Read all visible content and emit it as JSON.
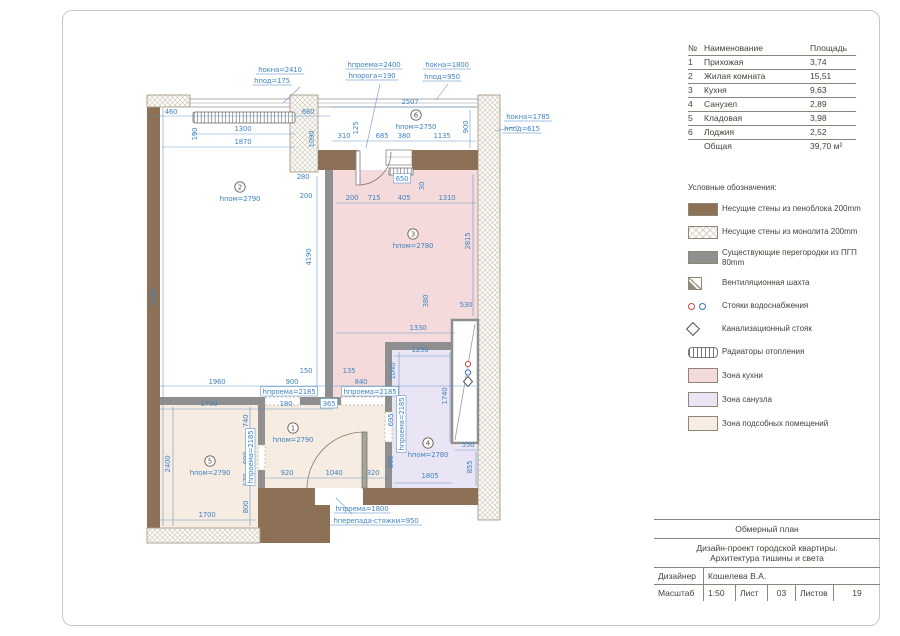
{
  "colors": {
    "wall_brown": "#8c7156",
    "partition_gray": "#8f8f8f",
    "zone_kitchen": "#f4dada",
    "zone_bath": "#e9e5f4",
    "zone_utility": "#f7ece2",
    "dim_blue": "#4385c2"
  },
  "table": {
    "headers": [
      "№",
      "Наименование",
      "Площадь"
    ],
    "rows": [
      [
        "1",
        "Прихожая",
        "3,74"
      ],
      [
        "2",
        "Жилая комната",
        "15,51"
      ],
      [
        "3",
        "Кухня",
        "9,63"
      ],
      [
        "4",
        "Санузел",
        "2,89"
      ],
      [
        "5",
        "Кладовая",
        "3,98"
      ],
      [
        "6",
        "Лоджия",
        "2,52"
      ]
    ],
    "total_label": "Общая",
    "total_value": "39,70 м²"
  },
  "legend": {
    "title": "Условные обозначения:",
    "items": [
      {
        "type": "color",
        "color": "#8c7156",
        "icon": "wall-foamblock-swatch",
        "label": "Несущие стены из пеноблока 200mm"
      },
      {
        "type": "hatch",
        "icon": "wall-monolith-swatch",
        "label": "Несущие стены из монолита 200mm"
      },
      {
        "type": "color",
        "color": "#8f8f8f",
        "icon": "partition-swatch",
        "label": "Существующие перегородки из ПГП 80mm"
      },
      {
        "type": "vent",
        "icon": "vent-shaft-icon",
        "label": "Вентиляционная шахта"
      },
      {
        "type": "risers",
        "dot_colors": [
          "#c34a3f",
          "#3f6fbc"
        ],
        "icon": "water-risers-icon",
        "label": "Стояки водоснабжения"
      },
      {
        "type": "diamond",
        "icon": "sewer-riser-icon",
        "label": "Канализационный стояк"
      },
      {
        "type": "radiator",
        "icon": "radiator-icon",
        "label": "Радиаторы отопления"
      },
      {
        "type": "zone",
        "color": "#f4dada",
        "icon": "kitchen-zone-swatch",
        "label": "Зона кухни"
      },
      {
        "type": "zone",
        "color": "#e9e5f4",
        "icon": "bath-zone-swatch",
        "label": "Зона санузла"
      },
      {
        "type": "zone",
        "color": "#f7ece2",
        "icon": "utility-zone-swatch",
        "label": "Зона подсобных помещений"
      }
    ]
  },
  "titleblock": {
    "plan_title": "Обмерный план",
    "project_line1": "Дизайн-проект городской квартиры.",
    "project_line2": "Архитектура тишины и света",
    "designer_label": "Дизайнер",
    "designer": "Кошелева В.А.",
    "scale_label": "Масштаб",
    "scale": "1:50",
    "sheet_label": "Лист",
    "sheet": "03",
    "sheets_label": "Листов",
    "sheets": "19"
  },
  "plan": {
    "rooms": [
      {
        "n": "2",
        "x": 240,
        "y": 187,
        "h": "hпом=2790"
      },
      {
        "n": "6",
        "x": 416,
        "y": 115,
        "h": "hпом=2750"
      },
      {
        "n": "3",
        "x": 413,
        "y": 234,
        "h": "hпом=2780"
      },
      {
        "n": "4",
        "x": 428,
        "y": 443,
        "h": "hпом=2780"
      },
      {
        "n": "1",
        "x": 293,
        "y": 428,
        "h": "hпом=2790"
      },
      {
        "n": "5",
        "x": 210,
        "y": 461,
        "h": "hпом=2790"
      }
    ],
    "dims": [
      {
        "t": "hокна=2410",
        "x": 280,
        "y": 72,
        "u": 1
      },
      {
        "t": "hпод=175",
        "x": 272,
        "y": 83,
        "u": 1
      },
      {
        "t": "hпроема=2400",
        "x": 374,
        "y": 67,
        "u": 1
      },
      {
        "t": "hпорога=190",
        "x": 372,
        "y": 78,
        "u": 1
      },
      {
        "t": "hокна=1800",
        "x": 447,
        "y": 67,
        "u": 1
      },
      {
        "t": "hпод=950",
        "x": 442,
        "y": 79,
        "u": 1
      },
      {
        "t": "hокна=1785",
        "x": 528,
        "y": 119,
        "u": 1
      },
      {
        "t": "hпод=615",
        "x": 522,
        "y": 131,
        "u": 1
      },
      {
        "t": "hпроема=1800",
        "x": 362,
        "y": 511,
        "u": 1
      },
      {
        "t": "hперепада-стяжки=950",
        "x": 376,
        "y": 523,
        "u": 1
      },
      {
        "t": "460",
        "x": 171,
        "y": 114
      },
      {
        "t": "1300",
        "x": 243,
        "y": 131
      },
      {
        "t": "1870",
        "x": 243,
        "y": 144
      },
      {
        "t": "190",
        "x": 197,
        "y": 134,
        "r": 1
      },
      {
        "t": "680",
        "x": 308,
        "y": 114
      },
      {
        "t": "1090",
        "x": 314,
        "y": 139,
        "r": 1
      },
      {
        "t": "2507",
        "x": 410,
        "y": 104
      },
      {
        "t": "900",
        "x": 468,
        "y": 127,
        "r": 1
      },
      {
        "t": "310",
        "x": 344,
        "y": 138
      },
      {
        "t": "125",
        "x": 358,
        "y": 128,
        "r": 1
      },
      {
        "t": "685",
        "x": 382,
        "y": 138
      },
      {
        "t": "380",
        "x": 404,
        "y": 138
      },
      {
        "t": "1135",
        "x": 442,
        "y": 138
      },
      {
        "t": "650",
        "x": 402,
        "y": 181,
        "b": 1
      },
      {
        "t": "30",
        "x": 424,
        "y": 186,
        "r": 1
      },
      {
        "t": "200",
        "x": 352,
        "y": 200
      },
      {
        "t": "715",
        "x": 374,
        "y": 200
      },
      {
        "t": "405",
        "x": 404,
        "y": 200
      },
      {
        "t": "1310",
        "x": 447,
        "y": 200
      },
      {
        "t": "280",
        "x": 303,
        "y": 179
      },
      {
        "t": "200",
        "x": 306,
        "y": 198
      },
      {
        "t": "2815",
        "x": 470,
        "y": 241,
        "r": 1
      },
      {
        "t": "4190",
        "x": 311,
        "y": 257,
        "r": 1
      },
      {
        "t": "5280",
        "x": 156,
        "y": 297,
        "r": 1
      },
      {
        "t": "380",
        "x": 428,
        "y": 301,
        "r": 1
      },
      {
        "t": "530",
        "x": 466,
        "y": 307
      },
      {
        "t": "1330",
        "x": 418,
        "y": 330
      },
      {
        "t": "1250",
        "x": 420,
        "y": 352
      },
      {
        "t": "1040",
        "x": 395,
        "y": 371,
        "r": 1
      },
      {
        "t": "1740",
        "x": 447,
        "y": 396,
        "r": 1
      },
      {
        "t": "150",
        "x": 306,
        "y": 373
      },
      {
        "t": "135",
        "x": 349,
        "y": 373
      },
      {
        "t": "1960",
        "x": 217,
        "y": 384
      },
      {
        "t": "900",
        "x": 292,
        "y": 384
      },
      {
        "t": "840",
        "x": 361,
        "y": 384
      },
      {
        "t": "hпроема=2185",
        "x": 289,
        "y": 394,
        "b": 1
      },
      {
        "t": "hпроема=2185",
        "x": 370,
        "y": 394,
        "b": 1
      },
      {
        "t": "1700",
        "x": 209,
        "y": 406
      },
      {
        "t": "180",
        "x": 286,
        "y": 406
      },
      {
        "t": "365",
        "x": 329,
        "y": 406,
        "b": 1
      },
      {
        "t": "740",
        "x": 248,
        "y": 421,
        "r": 1
      },
      {
        "t": "690",
        "x": 248,
        "y": 458,
        "r": 1
      },
      {
        "t": "170",
        "x": 248,
        "y": 480,
        "r": 1
      },
      {
        "t": "2400",
        "x": 170,
        "y": 464,
        "r": 1
      },
      {
        "t": "hпроема=2185",
        "x": 253,
        "y": 457,
        "r": 1,
        "b": 1
      },
      {
        "t": "695",
        "x": 393,
        "y": 420,
        "r": 1
      },
      {
        "t": "hпроема=2185",
        "x": 404,
        "y": 424,
        "r": 1,
        "b": 1
      },
      {
        "t": "860",
        "x": 393,
        "y": 462,
        "r": 1
      },
      {
        "t": "920",
        "x": 287,
        "y": 475
      },
      {
        "t": "1040",
        "x": 334,
        "y": 475
      },
      {
        "t": "320",
        "x": 373,
        "y": 475
      },
      {
        "t": "1805",
        "x": 430,
        "y": 478
      },
      {
        "t": "550",
        "x": 468,
        "y": 447
      },
      {
        "t": "855",
        "x": 472,
        "y": 467,
        "r": 1
      },
      {
        "t": "800",
        "x": 248,
        "y": 507,
        "r": 1
      },
      {
        "t": "1700",
        "x": 207,
        "y": 517
      }
    ]
  }
}
